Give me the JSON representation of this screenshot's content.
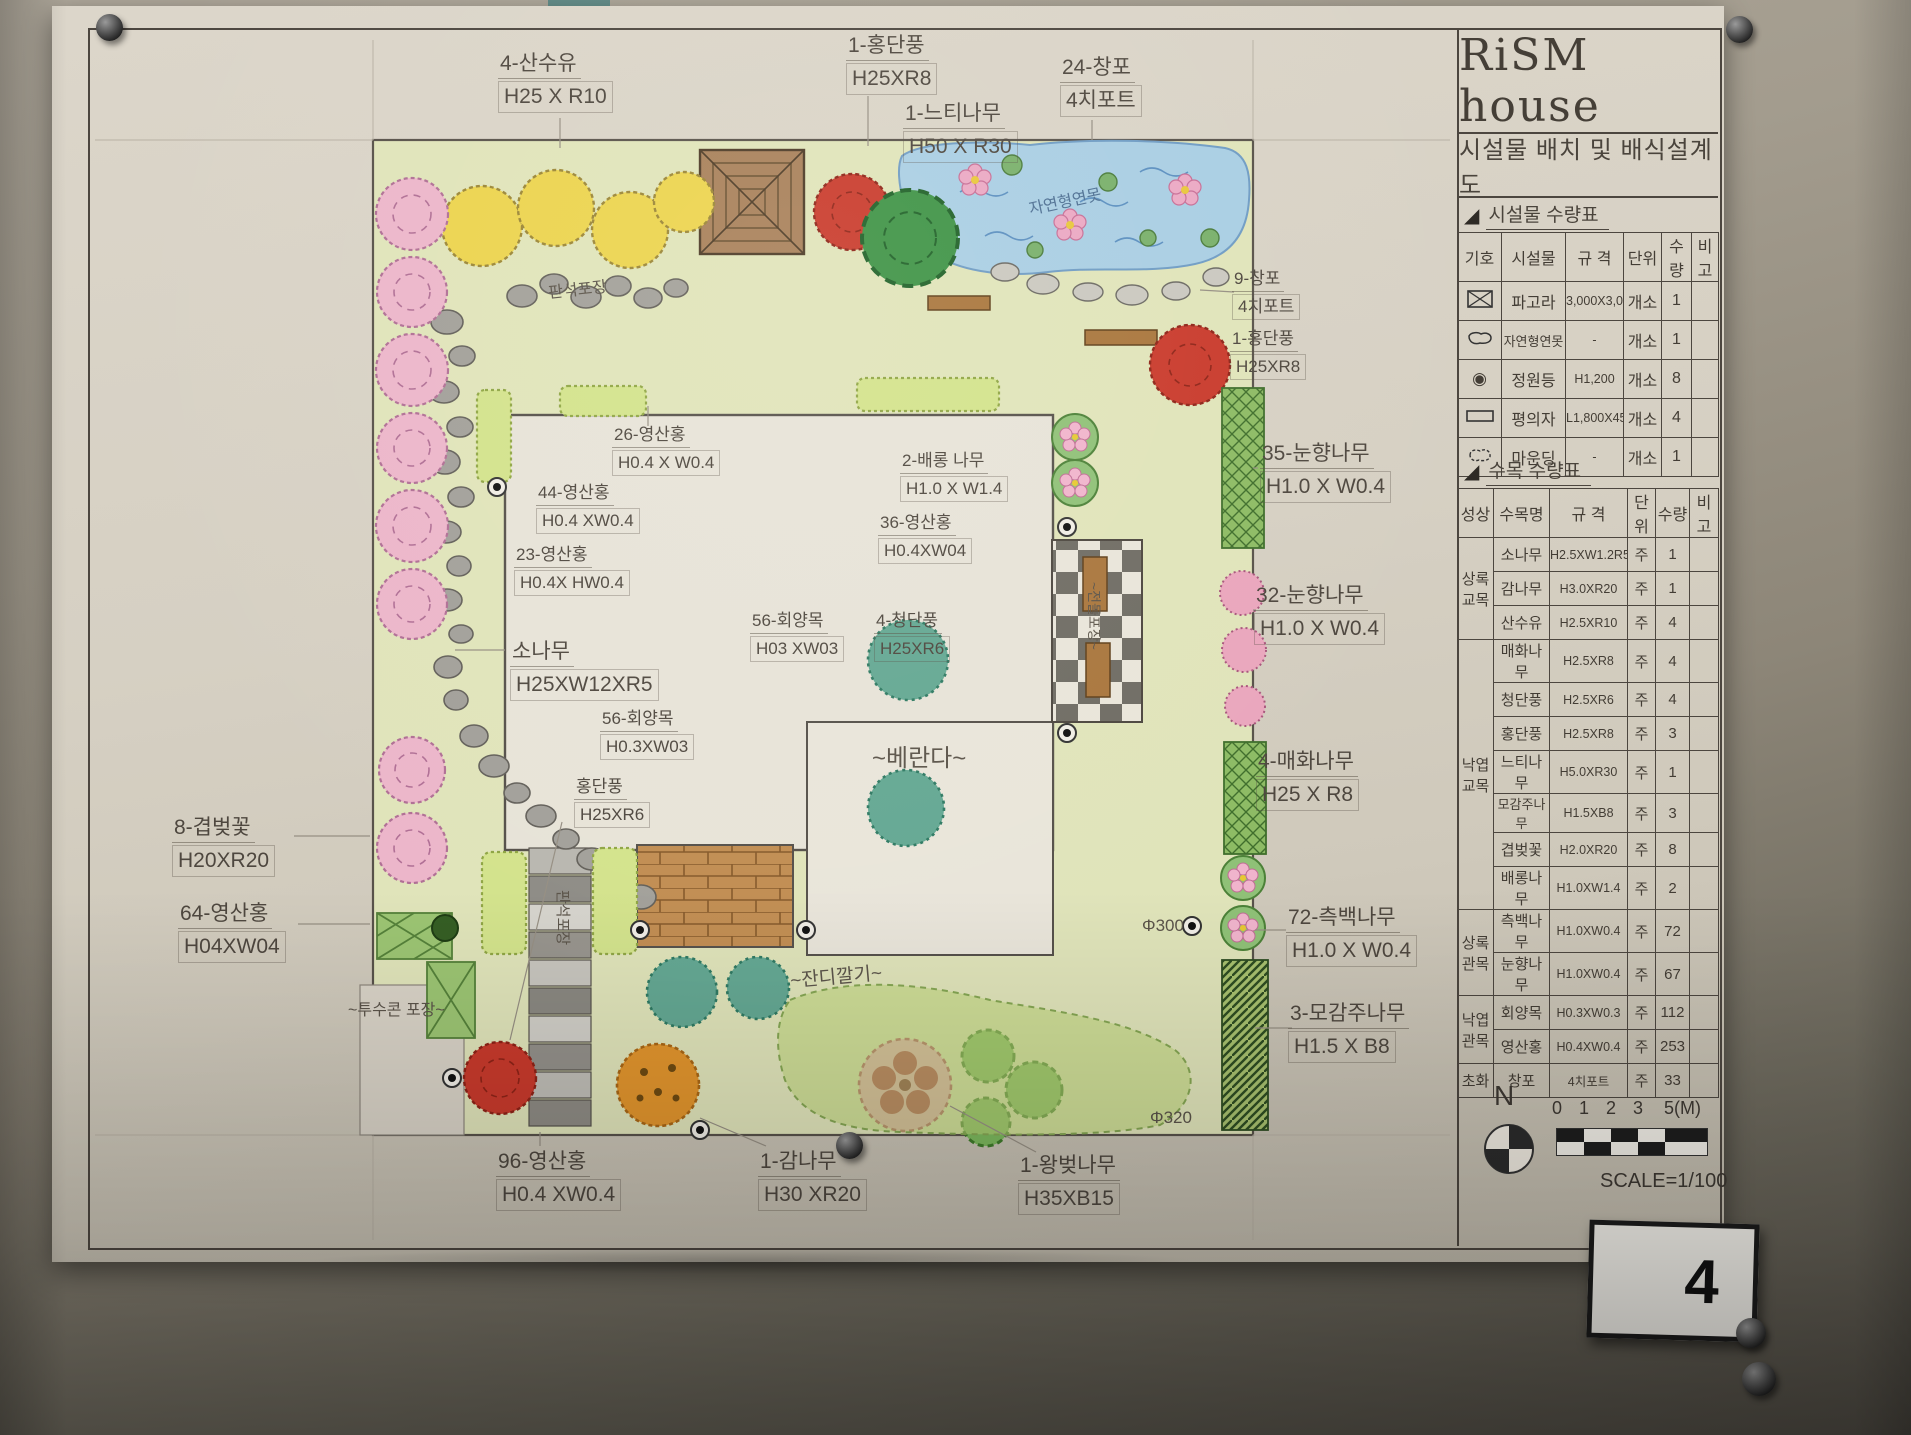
{
  "header": {
    "title": "RiSM house",
    "subtitle": "시설물 배치 및 배식설계도"
  },
  "icons": {
    "section_marker": "◢",
    "garden_light_symbol": "◉"
  },
  "facility_table": {
    "section_title": "시설물 수량표",
    "headers": {
      "symbol": "기호",
      "name": "시설물",
      "spec": "규 격",
      "unit": "단위",
      "qty": "수량",
      "note": "비고"
    },
    "rows": [
      {
        "name": "파고라",
        "spec": "3,000X3,000",
        "unit": "개소",
        "qty": "1",
        "note": ""
      },
      {
        "name": "자연형연못",
        "spec": "-",
        "unit": "개소",
        "qty": "1",
        "note": ""
      },
      {
        "name": "정원등",
        "spec": "H1,200",
        "unit": "개소",
        "qty": "8",
        "note": ""
      },
      {
        "name": "평의자",
        "spec": "L1,800X450",
        "unit": "개소",
        "qty": "4",
        "note": ""
      },
      {
        "name": "마운딩",
        "spec": "-",
        "unit": "개소",
        "qty": "1",
        "note": ""
      }
    ]
  },
  "tree_table": {
    "section_title": "수목 수량표",
    "headers": {
      "category": "성상",
      "name": "수목명",
      "spec": "규 격",
      "unit": "단위",
      "qty": "수량",
      "note": "비고"
    },
    "rows": [
      {
        "category": "상록\n교목",
        "name": "소나무",
        "spec": "H2.5XW1.2R5",
        "unit": "주",
        "qty": "1",
        "note": ""
      },
      {
        "category": "",
        "name": "감나무",
        "spec": "H3.0XR20",
        "unit": "주",
        "qty": "1",
        "note": ""
      },
      {
        "category": "",
        "name": "산수유",
        "spec": "H2.5XR10",
        "unit": "주",
        "qty": "4",
        "note": ""
      },
      {
        "category": "낙엽\n교목",
        "name": "매화나무",
        "spec": "H2.5XR8",
        "unit": "주",
        "qty": "4",
        "note": ""
      },
      {
        "category": "",
        "name": "청단풍",
        "spec": "H2.5XR6",
        "unit": "주",
        "qty": "4",
        "note": ""
      },
      {
        "category": "",
        "name": "홍단풍",
        "spec": "H2.5XR8",
        "unit": "주",
        "qty": "3",
        "note": ""
      },
      {
        "category": "",
        "name": "느티나무",
        "spec": "H5.0XR30",
        "unit": "주",
        "qty": "1",
        "note": ""
      },
      {
        "category": "",
        "name": "모감주나무",
        "spec": "H1.5XB8",
        "unit": "주",
        "qty": "3",
        "note": ""
      },
      {
        "category": "",
        "name": "겹벚꽃",
        "spec": "H2.0XR20",
        "unit": "주",
        "qty": "8",
        "note": ""
      },
      {
        "category": "",
        "name": "배롱나무",
        "spec": "H1.0XW1.4",
        "unit": "주",
        "qty": "2",
        "note": ""
      },
      {
        "category": "상록\n관목",
        "name": "측백나무",
        "spec": "H1.0XW0.4",
        "unit": "주",
        "qty": "72",
        "note": ""
      },
      {
        "category": "",
        "name": "눈향나무",
        "spec": "H1.0XW0.4",
        "unit": "주",
        "qty": "67",
        "note": ""
      },
      {
        "category": "낙엽\n관목",
        "name": "회양목",
        "spec": "H0.3XW0.3",
        "unit": "주",
        "qty": "112",
        "note": ""
      },
      {
        "category": "",
        "name": "영산홍",
        "spec": "H0.4XW0.4",
        "unit": "주",
        "qty": "253",
        "note": ""
      },
      {
        "category": "초화",
        "name": "창포",
        "spec": "4치포트",
        "unit": "주",
        "qty": "33",
        "note": ""
      }
    ]
  },
  "plan": {
    "callouts": [
      {
        "l1": "4-산수유",
        "l2": "H25 X R10"
      },
      {
        "l1": "1-홍단풍",
        "l2": "H25XR8"
      },
      {
        "l1": "1-느티나무",
        "l2": "H50 X R30"
      },
      {
        "l1": "24-창포",
        "l2": "4치포트"
      },
      {
        "l1": "9-창포",
        "l2": "4치포트"
      },
      {
        "l1": "1-홍단풍",
        "l2": "H25XR8"
      },
      {
        "l1": "35-눈향나무",
        "l2": "H1.0 X W0.4"
      },
      {
        "l1": "32-눈향나무",
        "l2": "H1.0 X W0.4"
      },
      {
        "l1": "4-매화나무",
        "l2": "H25 X R8"
      },
      {
        "l1": "72-측백나무",
        "l2": "H1.0 X W0.4"
      },
      {
        "l1": "3-모감주나무",
        "l2": "H1.5 X B8"
      },
      {
        "l1": "8-겹벚꽃",
        "l2": "H20XR20"
      },
      {
        "l1": "64-영산홍",
        "l2": "H04XW04"
      },
      {
        "l1": "96-영산홍",
        "l2": "H0.4 XW0.4"
      },
      {
        "l1": "1-감나무",
        "l2": "H30 XR20"
      },
      {
        "l1": "1-왕벚나무",
        "l2": "H35XB15"
      },
      {
        "l1": "26-영산홍",
        "l2": "H0.4 X W0.4"
      },
      {
        "l1": "44-영산홍",
        "l2": "H0.4 XW0.4"
      },
      {
        "l1": "23-영산홍",
        "l2": "H0.4X HW0.4"
      },
      {
        "l1": "소나무",
        "l2": "H25XW12XR5"
      },
      {
        "l1": "56-회양목",
        "l2": "H03 XW03"
      },
      {
        "l1": "4-청단풍",
        "l2": "H25XR6"
      },
      {
        "l1": "2-배롱 나무",
        "l2": "H1.0 X W1.4"
      },
      {
        "l1": "36-영산홍",
        "l2": "H0.4XW04"
      },
      {
        "l1": "56-회양목",
        "l2": "H0.3XW03"
      },
      {
        "l1": "홍단풍",
        "l2": "H25XR6"
      }
    ],
    "areas": {
      "veranda": "~베란다~",
      "pond": "자연형연못",
      "stepping_path": "판석포장",
      "stone_path": "판석포장",
      "checker_path": "~전돌포장~",
      "permeable": "~투수콘 포장~",
      "lawn": "~잔디깔기~",
      "dia300": "Φ300",
      "dia320": "Φ320"
    }
  },
  "scale": {
    "north": "N",
    "ticks": [
      "0",
      "1",
      "2",
      "3",
      "5(M)"
    ],
    "label": "SCALE=1/100"
  },
  "page_number": "4"
}
